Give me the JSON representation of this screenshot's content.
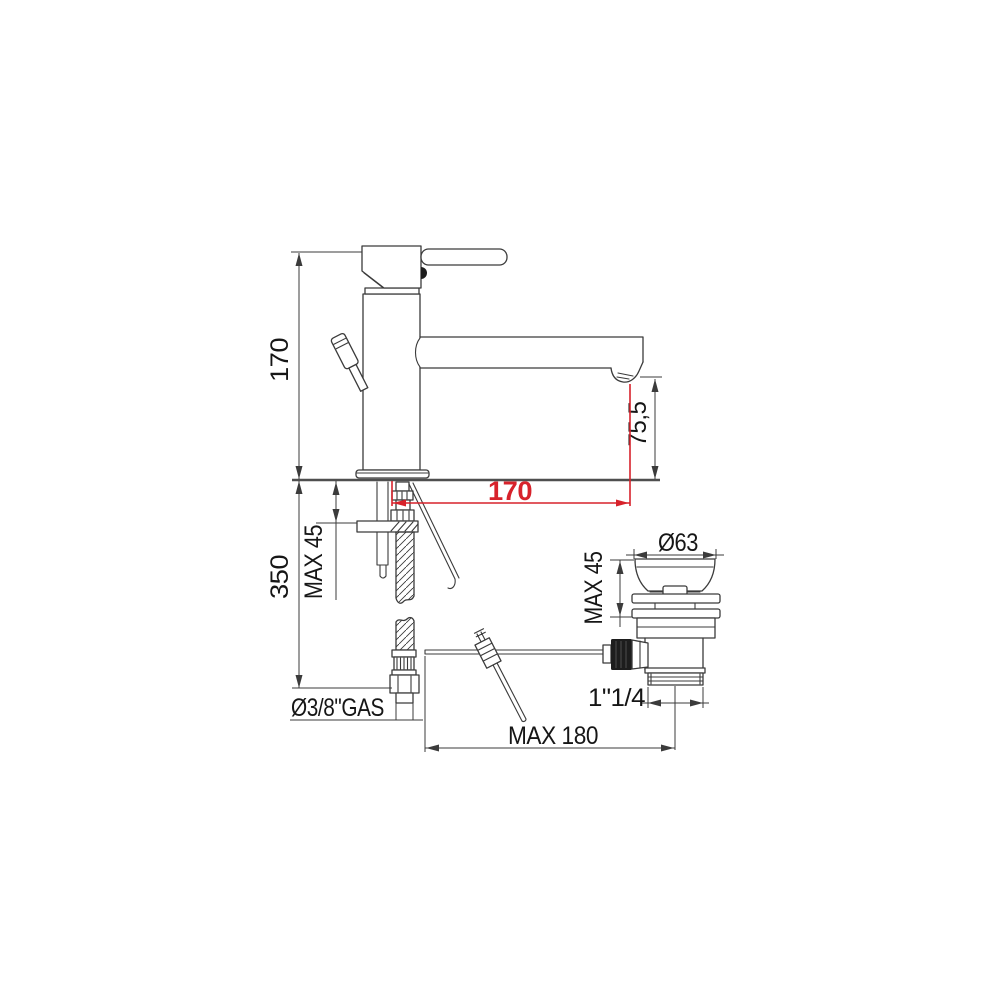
{
  "drawing_type": "single-lever basin mixer technical dimension drawing",
  "colors": {
    "line": "#3b3b3b",
    "deck_line": "#4f4f4f",
    "accent_red": "#d7222b",
    "text": "#161616",
    "background": "#ffffff"
  },
  "faucet_view": {
    "dim_height_above_deck": "170",
    "dim_below_deck_depth": "350",
    "dim_max_deck_thickness": "MAX 45",
    "dim_supply_thread": "Ø3/8\"GAS",
    "dim_spout_reach": "170",
    "dim_outlet_height": "75,5"
  },
  "drain_view": {
    "dim_flange_diameter": "Ø63",
    "dim_max_deck_thickness": "MAX 45",
    "dim_waste_thread": "1\"1/4",
    "dim_rod_max_length": "MAX 180"
  }
}
